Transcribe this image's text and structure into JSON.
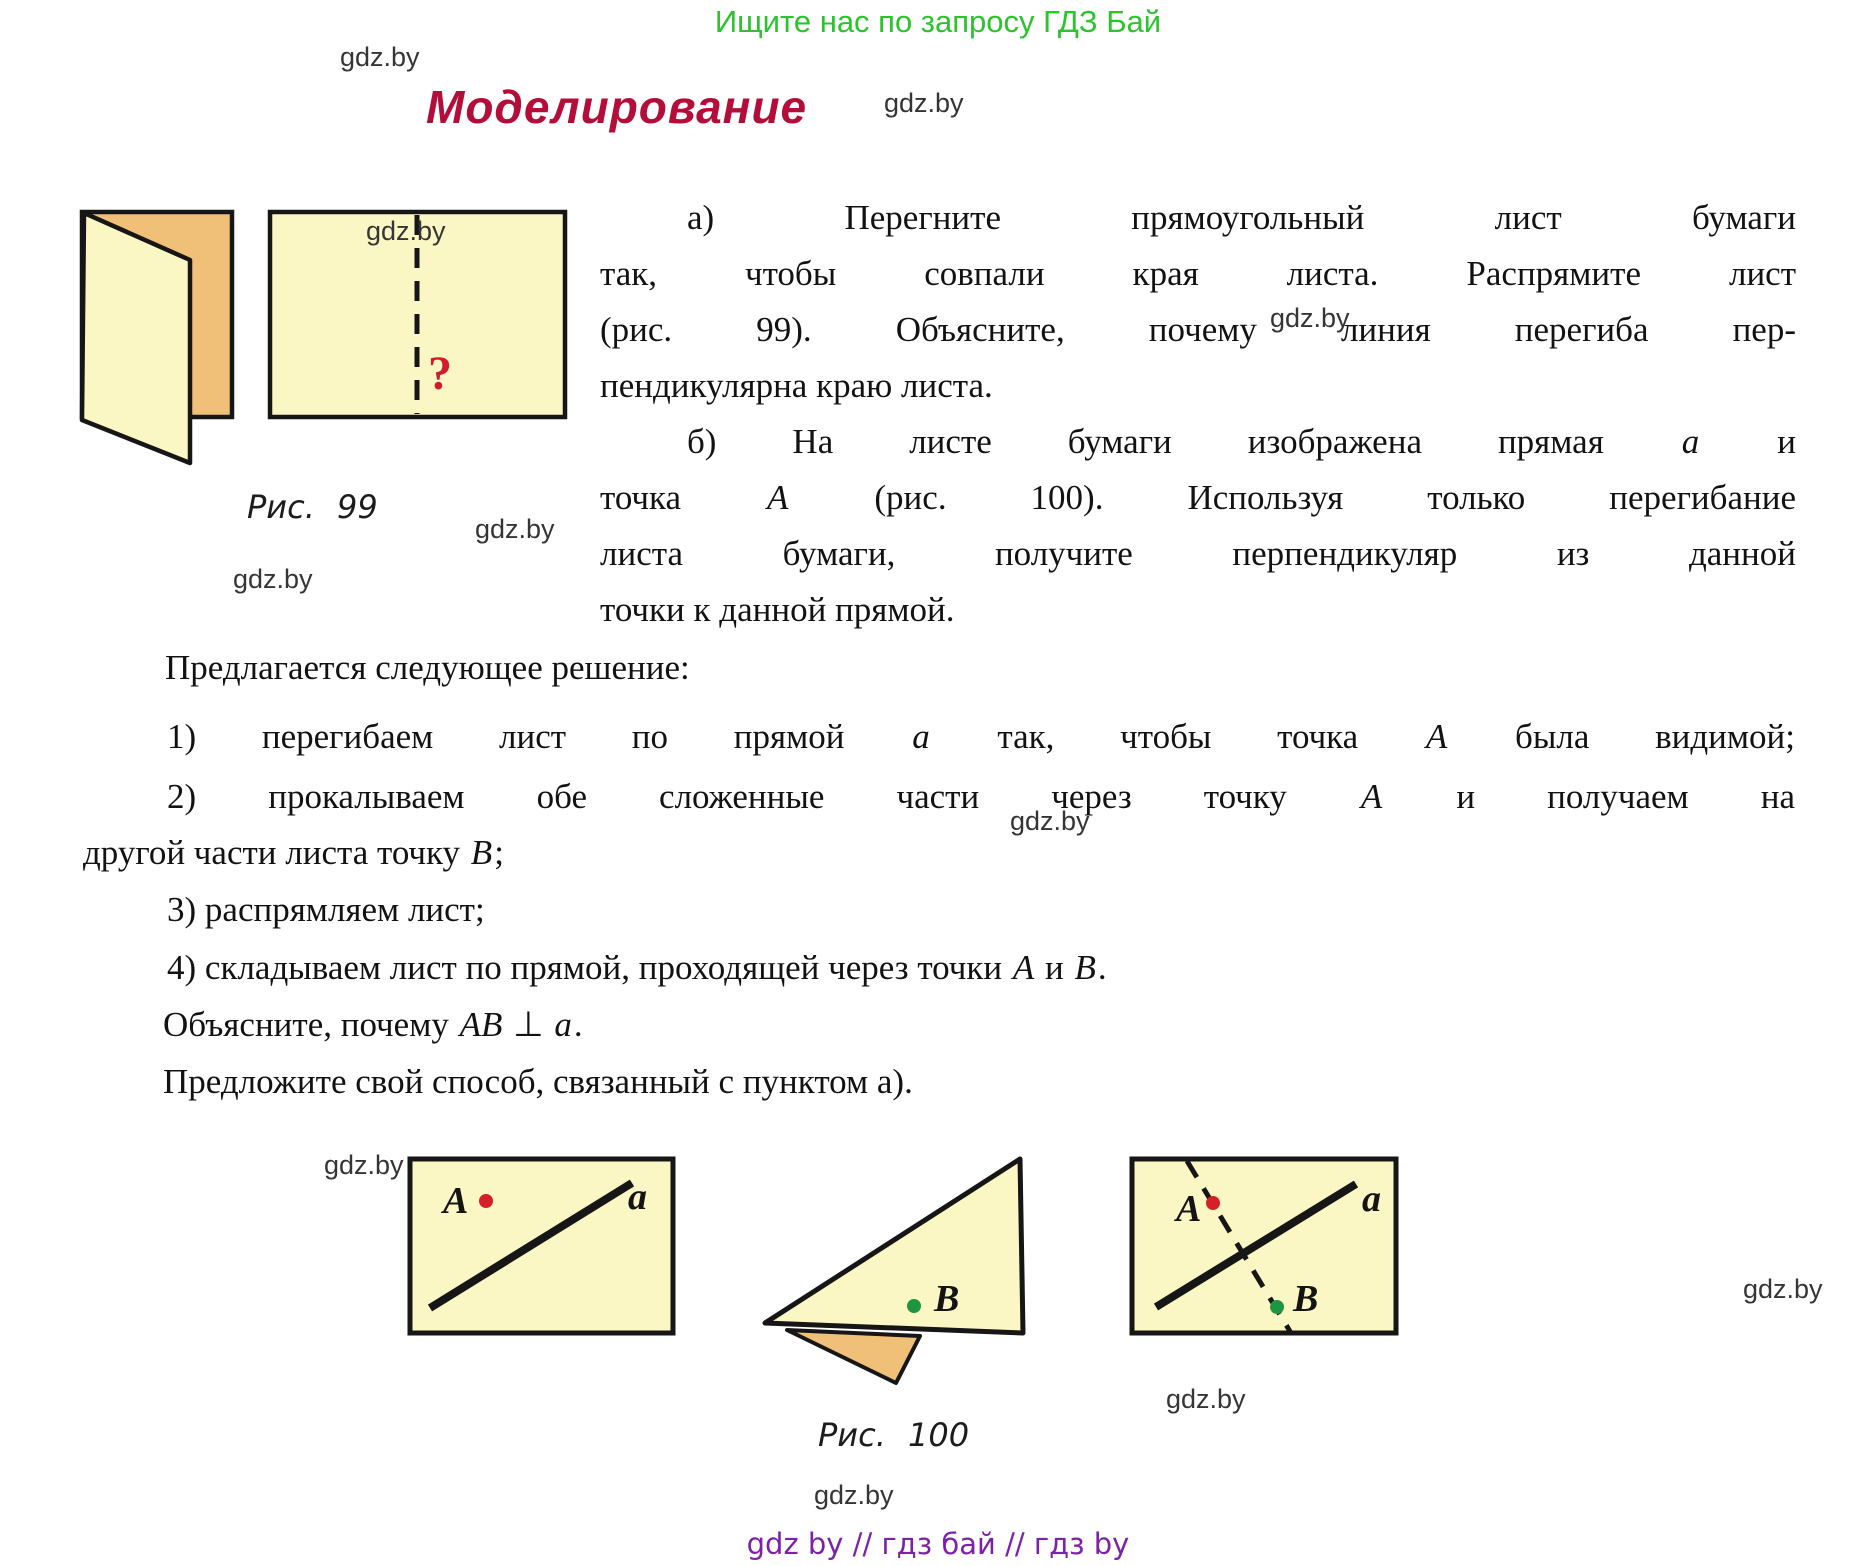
{
  "header": {
    "promo": "Ищите нас по запросу ГДЗ Бай"
  },
  "title": "Моделирование",
  "watermark": "gdz.by",
  "paragraph_a": {
    "lines": [
      "а) Перегните прямоугольный лист бумаги",
      "так, чтобы совпали края листа. Распрямите лист",
      "(рис. 99). Объясните, почему линия перегиба пер-",
      "пендикулярна краю листа."
    ]
  },
  "paragraph_b": {
    "lines": [
      "б) На листе бумаги изображена прямая a и",
      "точка A (рис. 100). Используя только перегибание",
      "листа бумаги, получите перпендикуляр из данной",
      "точки к данной прямой."
    ]
  },
  "solution_intro": "Предлагается следующее решение:",
  "steps": {
    "step1": "1) перегибаем лист по прямой a так, чтобы точка A была видимой;",
    "step2_line1": "2) прокалываем обе сложенные части через точку A и получаем на",
    "step2_line2": "другой части листа точку B;",
    "step3": "3) распрямляем лист;",
    "step4": "4) складываем лист по прямой, проходящей через точки A и B."
  },
  "outro": {
    "explain": "Объясните, почему AB ⊥ a.",
    "propose": "Предложите свой способ, связанный с пунктом а)."
  },
  "figure99": {
    "caption": "Рис. 99",
    "question_mark": "?"
  },
  "figure100": {
    "caption": "Рис. 100",
    "label_point_a": "A",
    "label_line_a": "a",
    "label_point_b": "B"
  },
  "footer": {
    "promo": "gdz by  //  гдз бай  //  гдз by"
  },
  "colors": {
    "paper_yellow": "#fbf7c4",
    "paper_orange": "#f0bf78",
    "title_crimson": "#b50d3a",
    "header_green": "#2cc42d",
    "footer_purple": "#7d22a8",
    "point_red": "#d42127",
    "point_green": "#1e9641",
    "stroke_black": "#161616"
  }
}
